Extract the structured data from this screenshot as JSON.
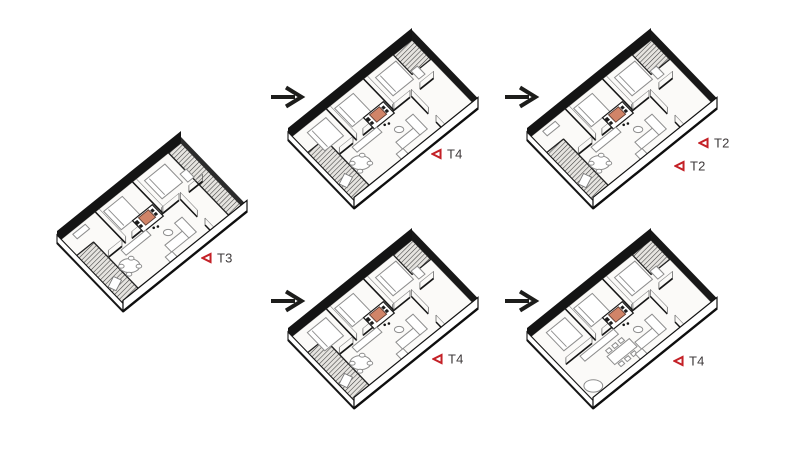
{
  "canvas": {
    "width": 800,
    "height": 450,
    "background": "#ffffff"
  },
  "palette": {
    "marker_red": "#c42127",
    "label_text": "#3e3a3b",
    "arrow_black": "#1d1d1b",
    "wall_black": "#141414",
    "accent_fill": "#d08468",
    "hatch_line": "#3c3c3c",
    "floor_fill": "#fbfaf8",
    "furniture_line": "#8d8d8d"
  },
  "plans": [
    {
      "id": "plan-1",
      "label": "T3",
      "origin": {
        "x": 57,
        "y": 243
      },
      "bedrooms": 2,
      "living": "round",
      "balconies": [
        "end_strip",
        "near_terrace"
      ]
    },
    {
      "id": "plan-2",
      "label": "T4",
      "origin": {
        "x": 288,
        "y": 140
      },
      "bedrooms": 3,
      "living": "round",
      "balconies": [
        "end_corner",
        "near_terrace"
      ]
    },
    {
      "id": "plan-3",
      "label": "T2",
      "origin": {
        "x": 527,
        "y": 140
      },
      "bedrooms": 2,
      "living": "round",
      "balconies": [
        "end_corner",
        "near_terrace"
      ]
    },
    {
      "id": "plan-4",
      "label": "T4",
      "origin": {
        "x": 288,
        "y": 340
      },
      "bedrooms": 3,
      "living": "round",
      "balconies": [
        "end_corner",
        "near_terrace"
      ]
    },
    {
      "id": "plan-5",
      "label": "T4",
      "origin": {
        "x": 527,
        "y": 340
      },
      "bedrooms": 3,
      "living": "dining",
      "balconies": [
        "end_corner"
      ]
    }
  ],
  "annotations": [
    {
      "text": "T3",
      "x": 201,
      "y": 258
    },
    {
      "text": "T4",
      "x": 431,
      "y": 154
    },
    {
      "text": "T2",
      "x": 698,
      "y": 143
    },
    {
      "text": "T2",
      "x": 674,
      "y": 166
    },
    {
      "text": "T4",
      "x": 432,
      "y": 359
    },
    {
      "text": "T4",
      "x": 673,
      "y": 361
    }
  ],
  "arrows": [
    {
      "x": 288,
      "y": 97
    },
    {
      "x": 522,
      "y": 97
    },
    {
      "x": 288,
      "y": 301
    },
    {
      "x": 522,
      "y": 301
    }
  ]
}
